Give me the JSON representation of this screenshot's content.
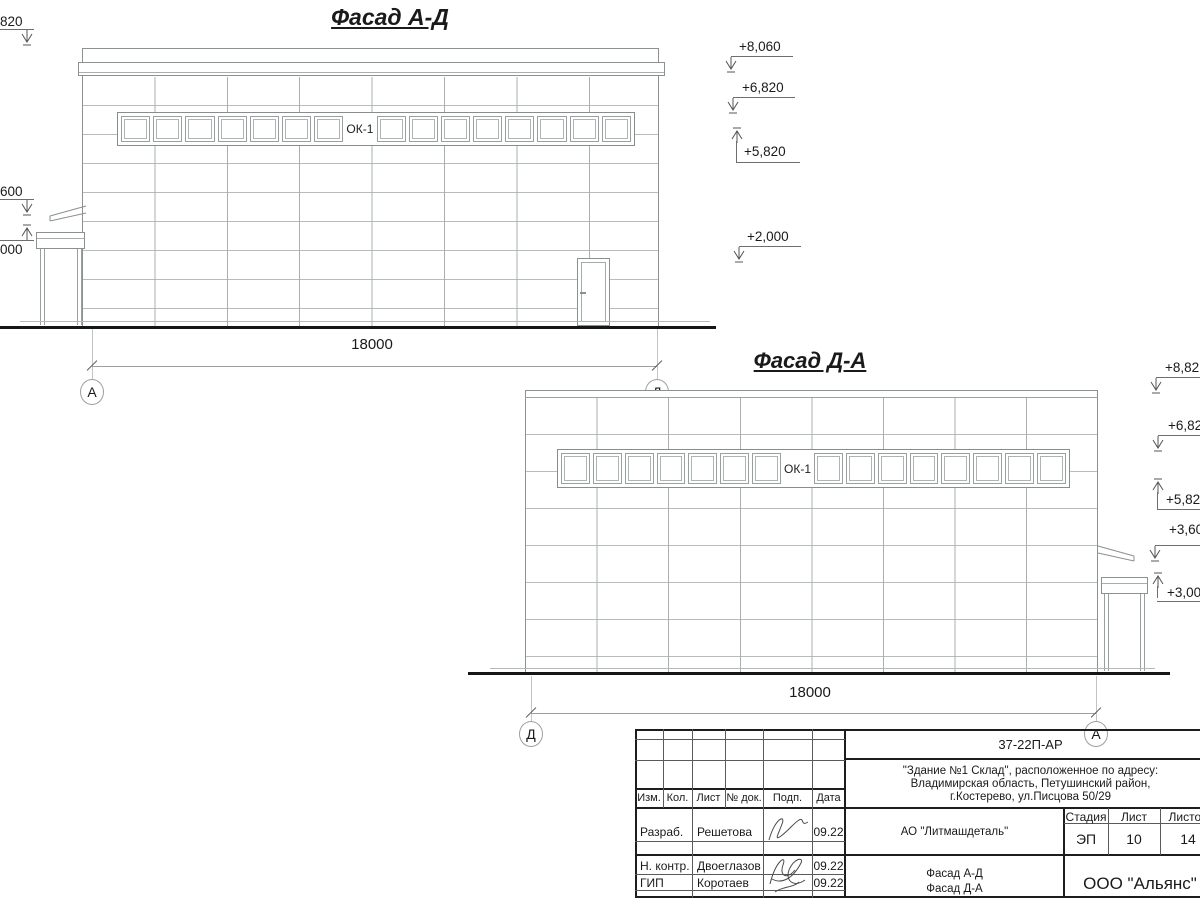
{
  "drawing": {
    "facade_ad": {
      "title": "Фасад А-Д",
      "window_label": "ОК-1",
      "dimension": "18000",
      "axis_left": "А",
      "axis_right": "Д",
      "windows": {
        "count": 16,
        "label_index": 7
      },
      "marks_left": [
        {
          "text": "820",
          "dir": "down"
        },
        {
          "text": "600",
          "dir": "down"
        },
        {
          "text": "000",
          "dir": "up"
        }
      ],
      "marks_right": [
        {
          "text": "+8,060",
          "dir": "down"
        },
        {
          "text": "+6,820",
          "dir": "down"
        },
        {
          "text": "+5,820",
          "dir": "up"
        },
        {
          "text": "+2,000",
          "dir": "down"
        }
      ]
    },
    "facade_da": {
      "title": "Фасад Д-А",
      "window_label": "ОК-1",
      "dimension": "18000",
      "axis_left": "Д",
      "axis_right": "А",
      "windows": {
        "count": 16,
        "label_index": 7
      },
      "marks_right": [
        {
          "text": "+8,82",
          "dir": "down"
        },
        {
          "text": "+6,82",
          "dir": "down"
        },
        {
          "text": "+5,82",
          "dir": "up"
        },
        {
          "text": "+3,60",
          "dir": "down"
        },
        {
          "text": "+3,00",
          "dir": "up"
        }
      ]
    }
  },
  "titleblock": {
    "doc_number": "37-22П-АР",
    "address_line1": "\"Здание №1 Склад\", расположенное по адресу:",
    "address_line2": "Владимирская область, Петушинский район,",
    "address_line3": "г.Костерево, ул.Писцова 50/29",
    "columns": [
      "Изм.",
      "Кол.",
      "Лист",
      "№ док.",
      "Подп.",
      "Дата"
    ],
    "rows": [
      {
        "role": "Разраб.",
        "name": "Решетова",
        "date": "09.22"
      },
      {
        "role": "Н. контр.",
        "name": "Двоеглазов",
        "date": "09.22"
      },
      {
        "role": "ГИП",
        "name": "Коротаев",
        "date": "09.22"
      }
    ],
    "company": "АО \"Литмашдеталь\"",
    "stage_label": "Стадия",
    "sheet_label": "Лист",
    "sheets_label": "Листов",
    "stage": "ЭП",
    "sheet": "10",
    "sheets": "14",
    "sheet_title_line1": "Фасад А-Д",
    "sheet_title_line2": "Фасад Д-А",
    "org": "ООО \"Альянс\""
  }
}
